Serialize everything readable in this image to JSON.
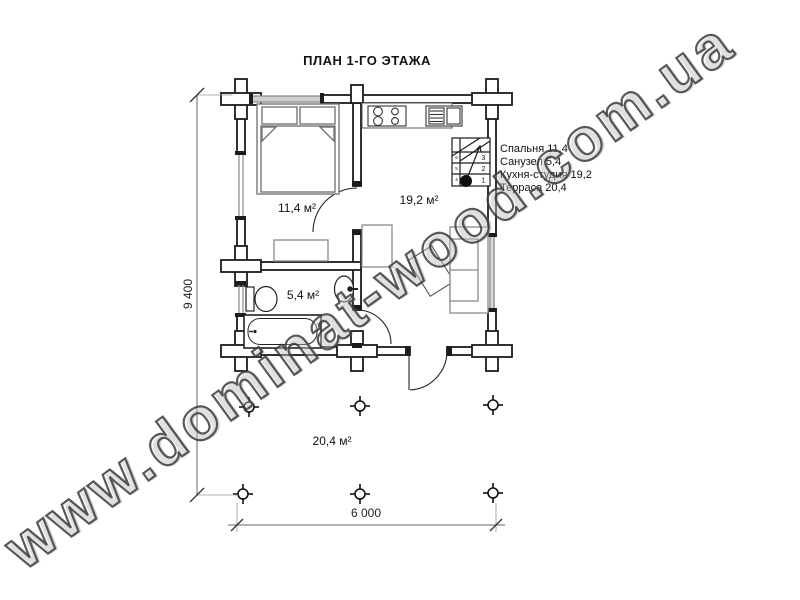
{
  "title": "ПЛАН 1-ГО ЭТАЖА",
  "watermark": "www.dominat-wood.com.ua",
  "rooms": {
    "bedroom_area": "11,4 м²",
    "kitchen_area": "19,2 м²",
    "bathroom_area": "5,4 м²",
    "terrace_area": "20,4 м²"
  },
  "legend": {
    "items": [
      "Спальня 11,4",
      "Санузел 5,4",
      "Кухня-студия 19,2",
      "Терраса 20,4"
    ]
  },
  "dimensions": {
    "overall_width_mm": "6 000",
    "overall_depth_mm": "9 400"
  },
  "stairs": {
    "tread_numbers": [
      "1",
      "2",
      "3"
    ],
    "upper_tread_numbers": [
      "4",
      "5",
      "6"
    ]
  },
  "colors": {
    "wall": "#1c1c1c",
    "furniture": "#8a8a8a",
    "dimension": "#666666",
    "background": "#ffffff"
  }
}
